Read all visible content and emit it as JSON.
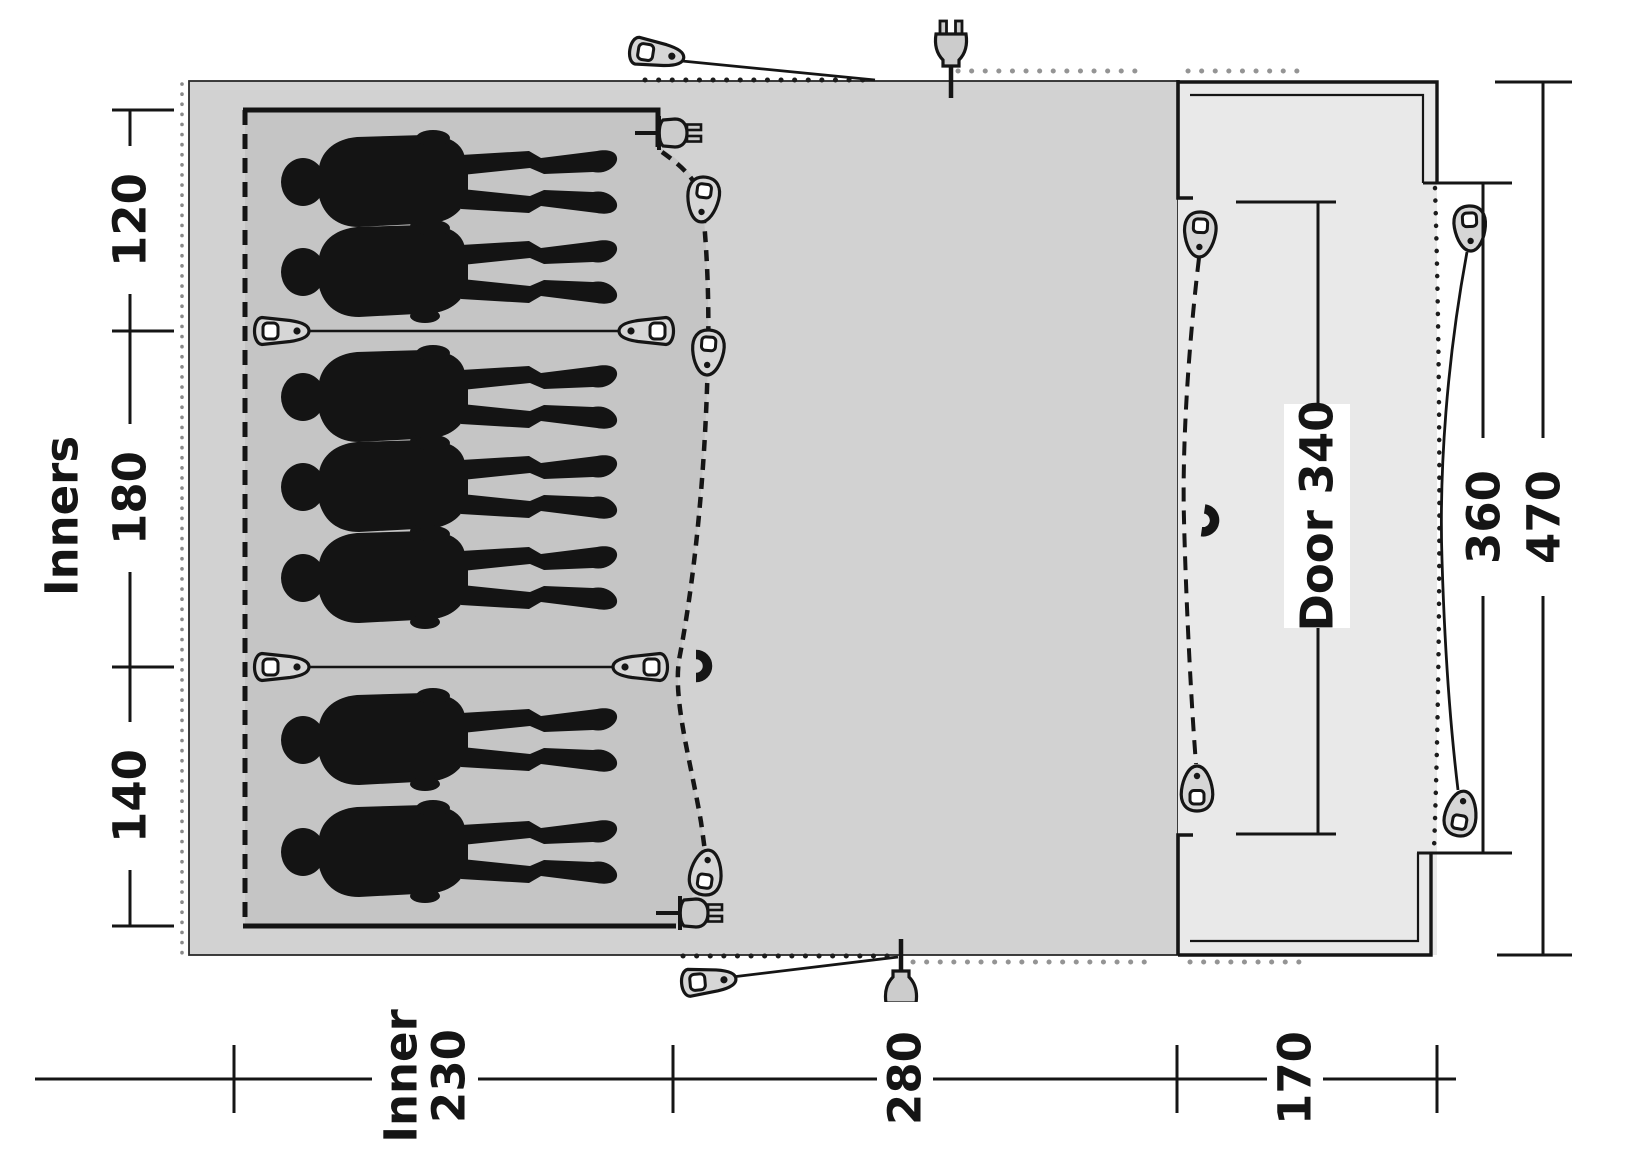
{
  "diagram": {
    "type": "tent-floorplan-top-view",
    "labels": {
      "inners_axis": "Inners",
      "compartments": [
        "120",
        "180",
        "140"
      ],
      "bottom": {
        "inner_line1": "Inner",
        "inner_line2": "230",
        "living": "280",
        "porch": "170"
      },
      "right": {
        "door": "Door 340",
        "front_opening": "360",
        "total_width": "470"
      }
    },
    "measurements": {
      "inner_compartment_widths_cm": [
        120,
        180,
        140
      ],
      "inner_depth_cm": 230,
      "living_area_depth_cm": 280,
      "porch_depth_cm": 170,
      "door_width_cm": 340,
      "front_opening_cm": 360,
      "total_width_cm": 470
    },
    "figures": {
      "sleeping_count": 7
    },
    "icons": [
      "toggle-icon",
      "zip-toggle-icon",
      "power-plug-icon",
      "magnet-icon",
      "guy-line-dots"
    ],
    "colors": {
      "tent_body": "#d2d2d2",
      "inner_bedroom": "#c5c5c5",
      "porch": "#e9e9e9",
      "line": "#1c1c1c",
      "dots_gray": "#949494",
      "figure": "#141414",
      "icon_fill": "#d6d6d6"
    }
  }
}
